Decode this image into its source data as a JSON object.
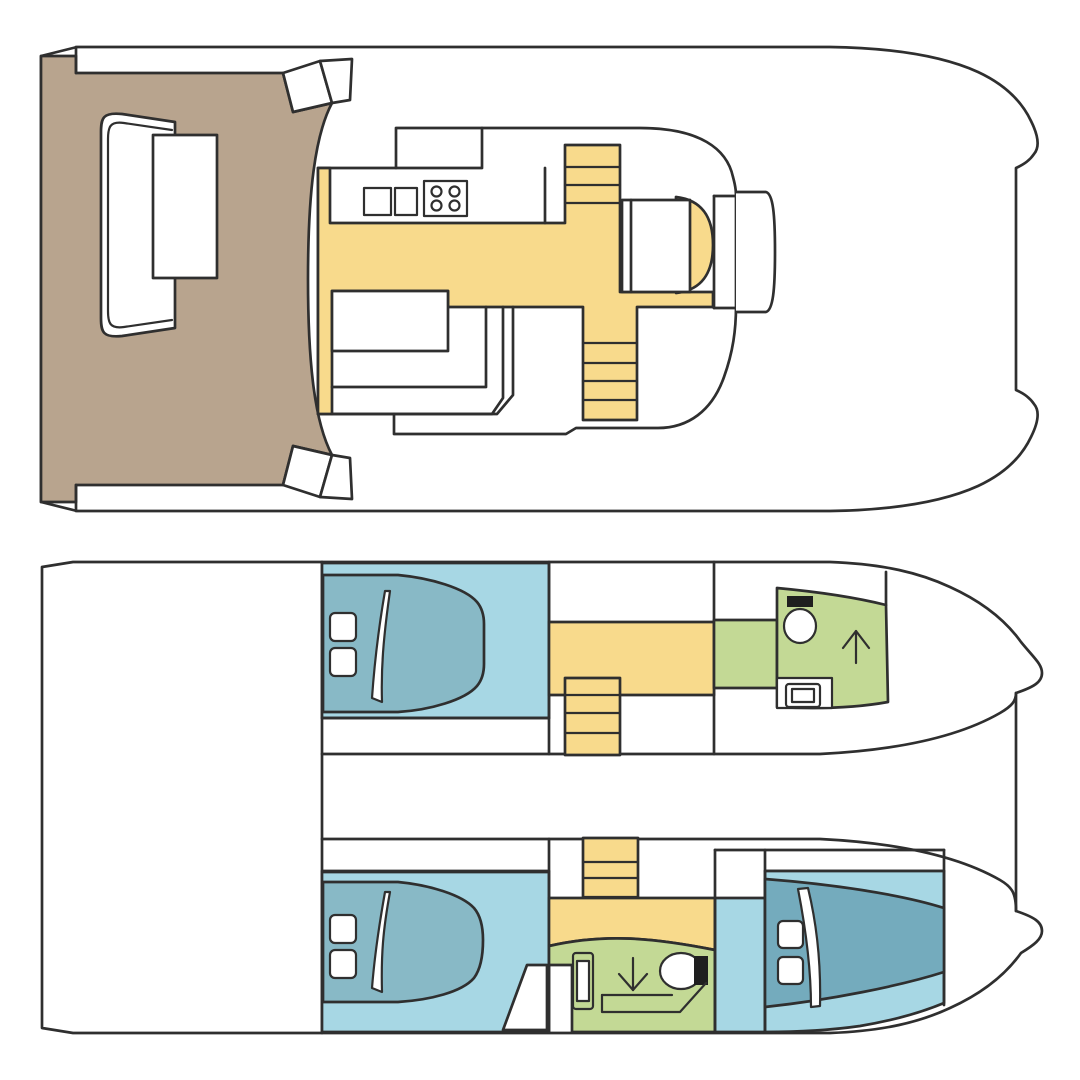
{
  "diagram": {
    "type": "boat-floor-plan",
    "vessel": "catamaran",
    "views": [
      {
        "id": "upper-deck",
        "rooms": [
          {
            "name": "aft-cockpit",
            "color_key": "cockpit_teak"
          },
          {
            "name": "saloon-galley",
            "color_key": "floor_yellow"
          },
          {
            "name": "foredeck",
            "color_key": "hull_white"
          }
        ],
        "features": [
          "cockpit-bench",
          "cockpit-table",
          "transom-steps",
          "galley-counter",
          "sink-icon",
          "stove-icon",
          "stairs-up-icon",
          "stairs-down-icon",
          "dinette-table",
          "dinette-bench",
          "nav-seat",
          "helm-seat",
          "windshield",
          "bow-seat"
        ]
      },
      {
        "id": "lower-deck",
        "rooms": [
          {
            "name": "aft-platform",
            "color_key": "hull_white"
          },
          {
            "name": "port-aft-cabin",
            "color_key": "cabin_blue_light"
          },
          {
            "name": "port-corridor",
            "color_key": "floor_yellow"
          },
          {
            "name": "port-bathroom",
            "color_key": "bath_green"
          },
          {
            "name": "starboard-aft-cabin",
            "color_key": "cabin_blue_light"
          },
          {
            "name": "starboard-corridor",
            "color_key": "floor_yellow"
          },
          {
            "name": "starboard-bathroom",
            "color_key": "bath_green"
          },
          {
            "name": "starboard-forward-cabin",
            "color_key": "cabin_blue_light"
          }
        ],
        "features": [
          "double-bed",
          "pillow-icon",
          "blanket-fold-icon",
          "stairs-icon",
          "toilet-icon",
          "shower-arrow-icon",
          "washbasin-icon",
          "wardrobe"
        ]
      }
    ]
  },
  "palette": {
    "outline": "#2f2f2f",
    "hull_white": "#ffffff",
    "cockpit_teak": "#b8a48e",
    "floor_yellow": "#f8da8c",
    "cabin_blue_light": "#a7d7e4",
    "bed_teal": "#88b9c6",
    "bed_teal_dark": "#74abbd",
    "bath_green": "#c3d995",
    "fixture_black": "#1f1f1f",
    "background": "#ffffff"
  }
}
